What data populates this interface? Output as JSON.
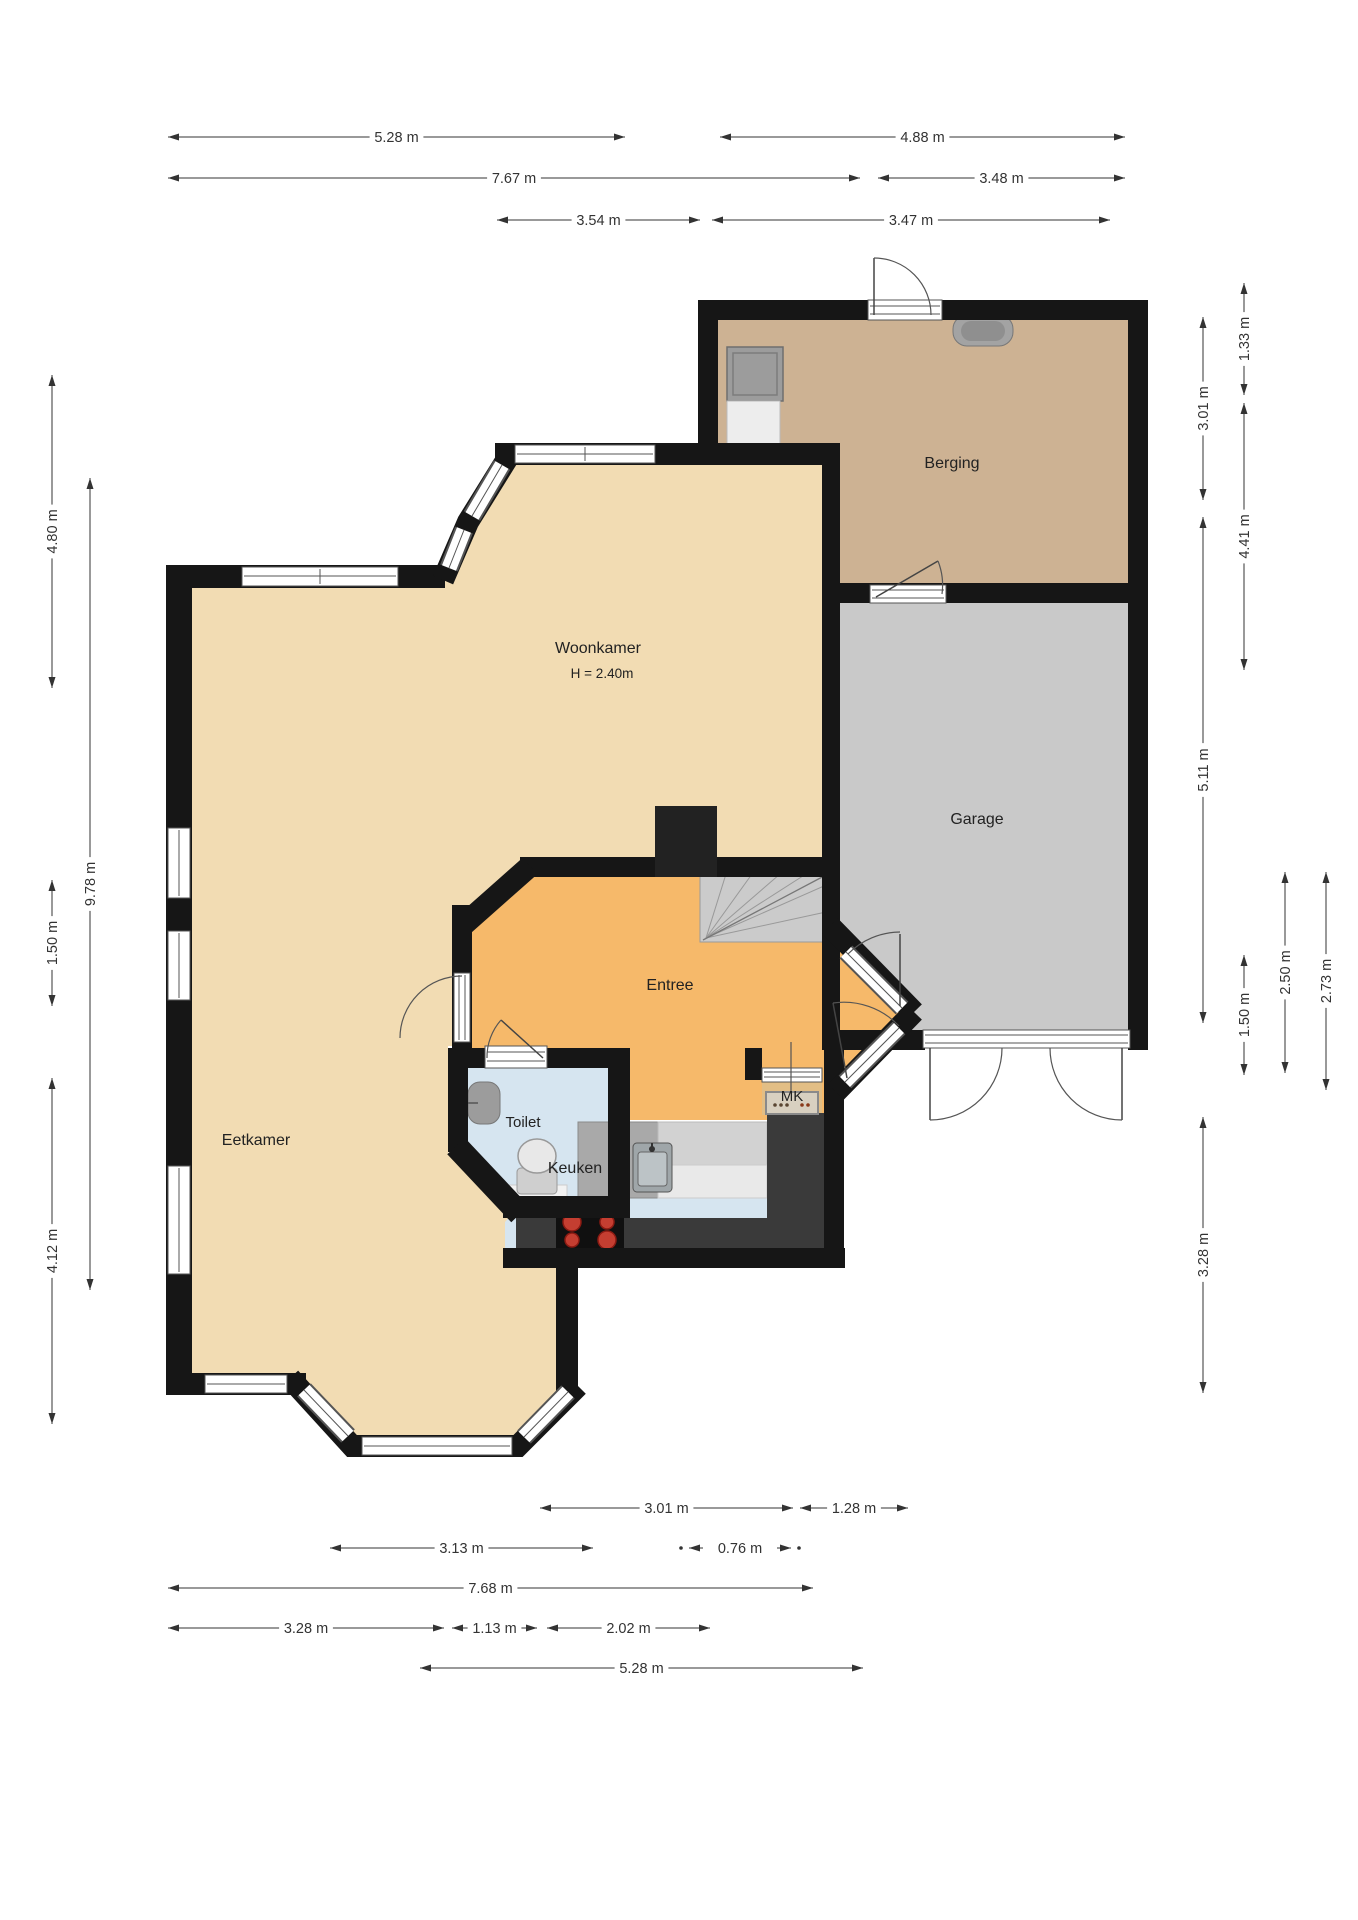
{
  "rooms": {
    "woonkamer": {
      "label": "Woonkamer",
      "height_note": "H = 2.40m"
    },
    "eetkamer": {
      "label": "Eetkamer"
    },
    "entree": {
      "label": "Entree"
    },
    "toilet": {
      "label": "Toilet"
    },
    "keuken": {
      "label": "Keuken"
    },
    "berging": {
      "label": "Berging"
    },
    "garage": {
      "label": "Garage"
    },
    "meterkast": {
      "label": "MK"
    }
  },
  "dimensions": [
    {
      "label": "5.28 m",
      "x1": 168,
      "y1": 137,
      "x2": 625,
      "y2": 137
    },
    {
      "label": "4.88 m",
      "x1": 720,
      "y1": 137,
      "x2": 1125,
      "y2": 137
    },
    {
      "label": "7.67 m",
      "x1": 168,
      "y1": 178,
      "x2": 860,
      "y2": 178
    },
    {
      "label": "3.48 m",
      "x1": 878,
      "y1": 178,
      "x2": 1125,
      "y2": 178
    },
    {
      "label": "3.54 m",
      "x1": 497,
      "y1": 220,
      "x2": 700,
      "y2": 220
    },
    {
      "label": "3.47 m",
      "x1": 712,
      "y1": 220,
      "x2": 1110,
      "y2": 220
    },
    {
      "label": "4.80 m",
      "x1": 52,
      "y1": 375,
      "x2": 52,
      "y2": 688
    },
    {
      "label": "9.78 m",
      "x1": 90,
      "y1": 478,
      "x2": 90,
      "y2": 1290
    },
    {
      "label": "1.50 m",
      "x1": 52,
      "y1": 880,
      "x2": 52,
      "y2": 1006
    },
    {
      "label": "4.12 m",
      "x1": 52,
      "y1": 1078,
      "x2": 52,
      "y2": 1424
    },
    {
      "label": "3.01 m",
      "x1": 1203,
      "y1": 317,
      "x2": 1203,
      "y2": 500
    },
    {
      "label": "1.33 m",
      "x1": 1244,
      "y1": 283,
      "x2": 1244,
      "y2": 395
    },
    {
      "label": "4.41 m",
      "x1": 1244,
      "y1": 403,
      "x2": 1244,
      "y2": 670
    },
    {
      "label": "5.11 m",
      "x1": 1203,
      "y1": 517,
      "x2": 1203,
      "y2": 1023
    },
    {
      "label": "1.50 m",
      "x1": 1244,
      "y1": 955,
      "x2": 1244,
      "y2": 1075
    },
    {
      "label": "2.50 m",
      "x1": 1285,
      "y1": 872,
      "x2": 1285,
      "y2": 1073
    },
    {
      "label": "2.73 m",
      "x1": 1326,
      "y1": 872,
      "x2": 1326,
      "y2": 1090
    },
    {
      "label": "3.28 m",
      "x1": 1203,
      "y1": 1117,
      "x2": 1203,
      "y2": 1393
    },
    {
      "label": "3.01 m",
      "x1": 540,
      "y1": 1508,
      "x2": 793,
      "y2": 1508
    },
    {
      "label": "1.28 m",
      "x1": 800,
      "y1": 1508,
      "x2": 908,
      "y2": 1508
    },
    {
      "label": "3.13 m",
      "x1": 330,
      "y1": 1548,
      "x2": 593,
      "y2": 1548
    },
    {
      "label": "0.76 m",
      "x1": 705,
      "y1": 1548,
      "x2": 775,
      "y2": 1548,
      "style": "inward"
    },
    {
      "label": "7.68 m",
      "x1": 168,
      "y1": 1588,
      "x2": 813,
      "y2": 1588
    },
    {
      "label": "3.28 m",
      "x1": 168,
      "y1": 1628,
      "x2": 444,
      "y2": 1628
    },
    {
      "label": "1.13 m",
      "x1": 452,
      "y1": 1628,
      "x2": 537,
      "y2": 1628
    },
    {
      "label": "2.02 m",
      "x1": 547,
      "y1": 1628,
      "x2": 710,
      "y2": 1628
    },
    {
      "label": "5.28 m",
      "x1": 420,
      "y1": 1668,
      "x2": 863,
      "y2": 1668
    }
  ],
  "colors": {
    "floor-cream": "#F2DCB3",
    "floor-entree": "#F6B96A",
    "floor-berging": "#CDB293",
    "floor-garage": "#C9C9C9",
    "floor-wet": "#D6E5F0",
    "floor-mk": "#E2BE85",
    "wall": "#161616",
    "counter-dark": "#3A3A3A",
    "counter-gray": "#A9A9A9",
    "counter-light": "#D2D2D2",
    "stairs": "#CBCBCB",
    "burner-red": "#C43E31"
  }
}
